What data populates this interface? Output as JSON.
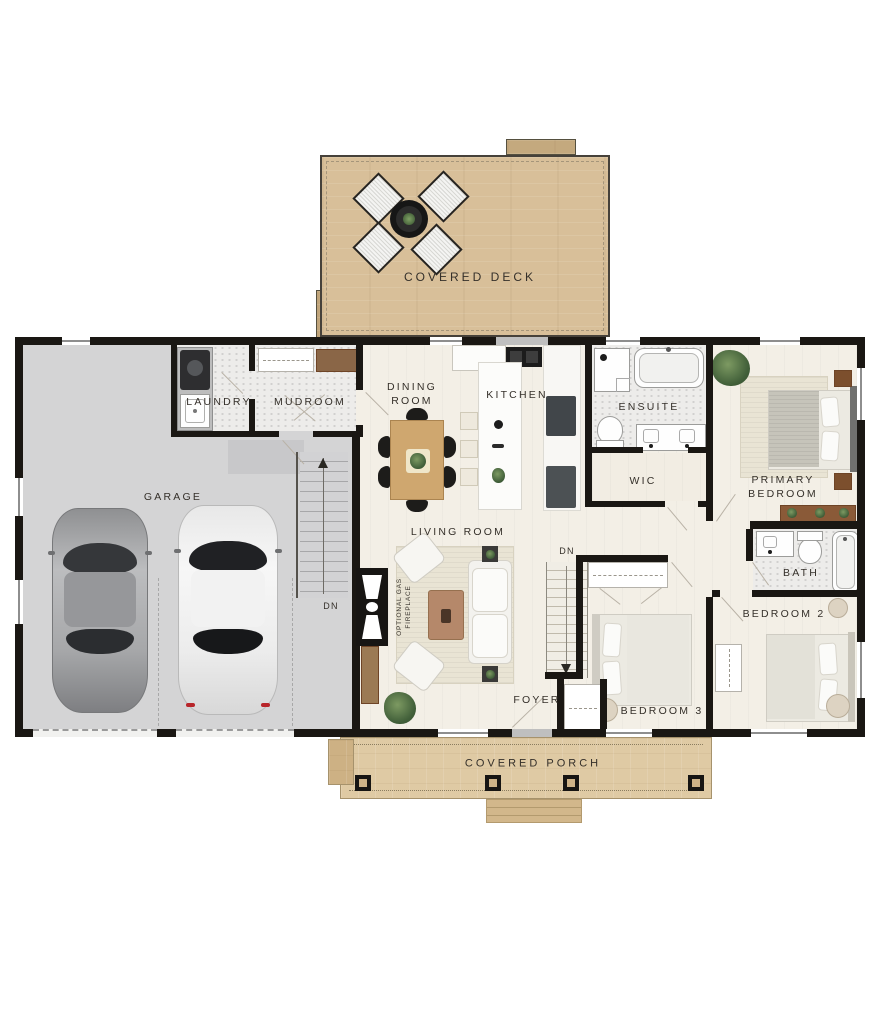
{
  "colors": {
    "wall": "#1a1713",
    "deck_wood": "#d8bf99",
    "porch_wood": "#dfcaa4",
    "garage_floor": "#d4d4d5",
    "interior_floor": "#f3efe6",
    "label": "#35302a",
    "accent_wood": "#cfa76f"
  },
  "labels": {
    "covered_deck": "COVERED DECK",
    "laundry": "LAUNDRY",
    "mudroom": "MUDROOM",
    "dining_room": "DINING\nROOM",
    "kitchen": "KITCHEN",
    "ensuite": "ENSUITE",
    "wic": "WIC",
    "primary_bedroom": "PRIMARY\nBEDROOM",
    "garage": "GARAGE",
    "living_room": "LIVING ROOM",
    "bath": "BATH",
    "bedroom_2": "BEDROOM 2",
    "bedroom_3": "BEDROOM 3",
    "foyer": "FOYER",
    "covered_porch": "COVERED PORCH",
    "dn_garage": "DN",
    "dn_foyer": "DN",
    "optional_fireplace": "OPTIONAL GAS\nFIREPLACE"
  },
  "fixtures": [
    "patio-table",
    "patio-chair",
    "car",
    "staircase",
    "washer-dryer",
    "laundry-sink",
    "coat-closet",
    "mudroom-bench",
    "dining-table",
    "dining-chair",
    "kitchen-island",
    "island-sink",
    "range",
    "refrigerator",
    "bar-stool",
    "shower",
    "bathtub",
    "toilet",
    "double-vanity",
    "double-bed",
    "nightstand",
    "dresser",
    "area-rug",
    "sofa",
    "accent-chair",
    "coffee-table",
    "side-table",
    "gas-fireplace",
    "potted-plant",
    "porch-post",
    "porch-steps",
    "closet",
    "pouf"
  ]
}
